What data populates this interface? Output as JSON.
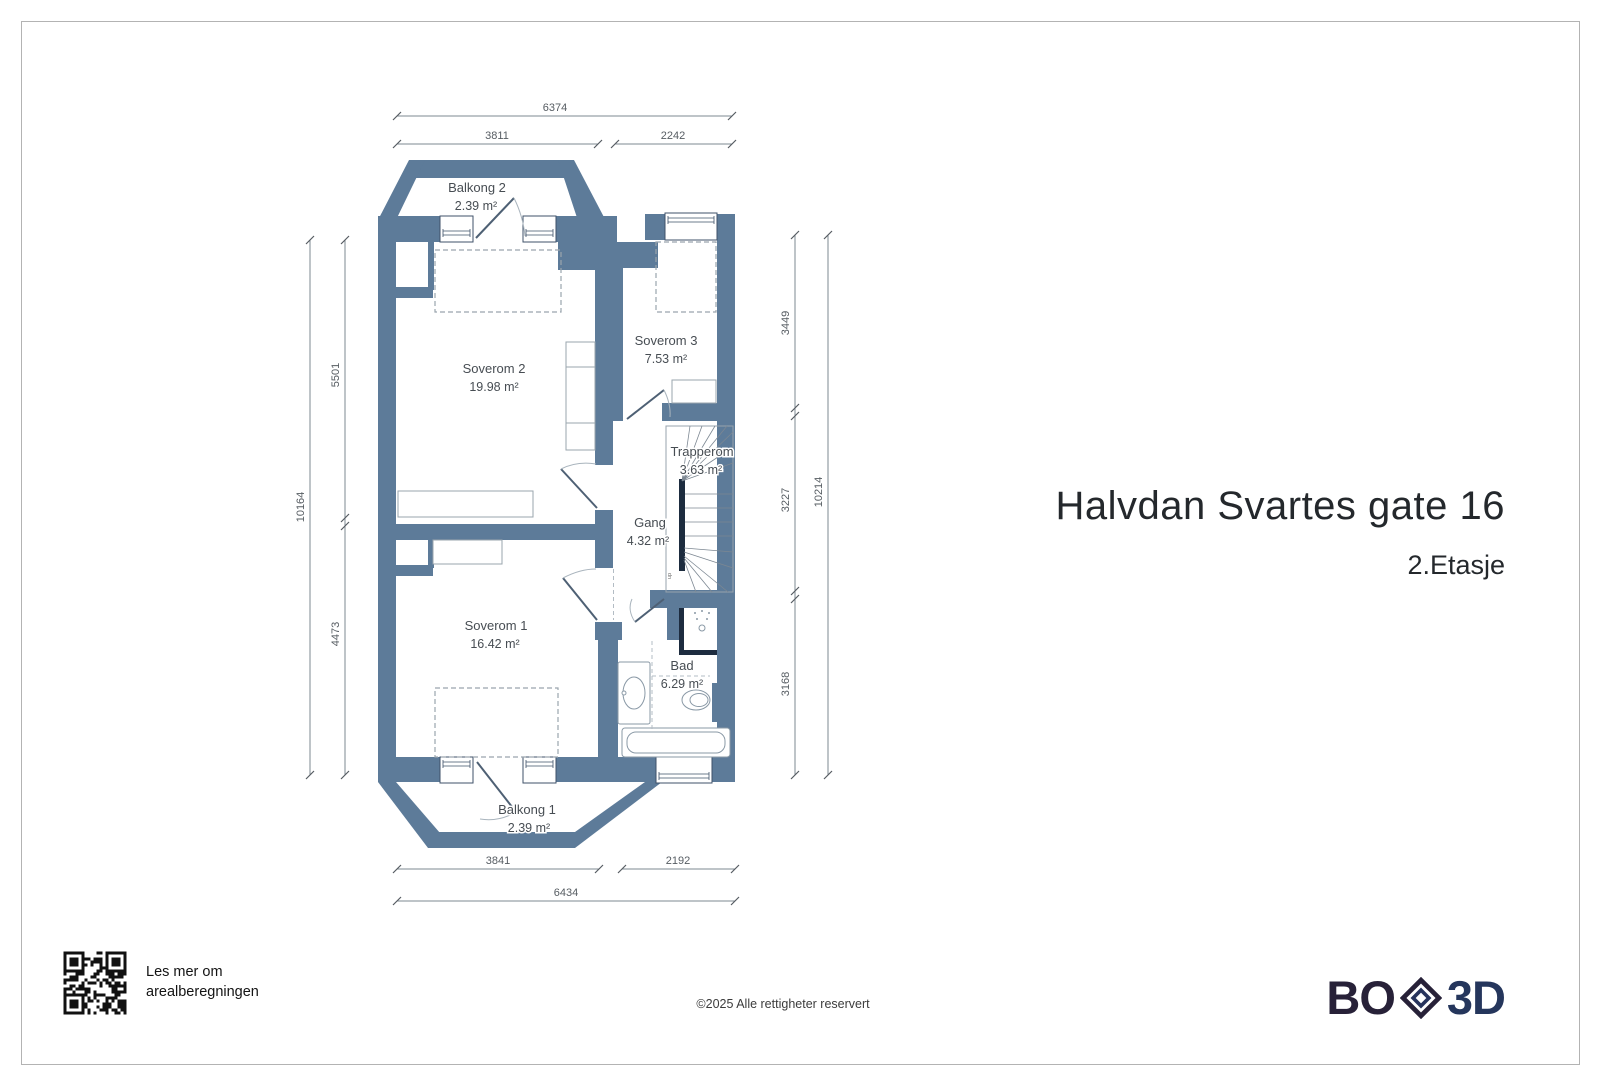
{
  "header": {
    "title": "Halvdan Svartes gate 16",
    "subtitle": "2.Etasje"
  },
  "rooms": {
    "balkong2": {
      "name": "Balkong 2",
      "area": "2.39 m²"
    },
    "soverom2": {
      "name": "Soverom 2",
      "area": "19.98 m²"
    },
    "soverom3": {
      "name": "Soverom 3",
      "area": "7.53 m²"
    },
    "trapperom": {
      "name": "Trapperom",
      "area": "3.63 m²"
    },
    "gang": {
      "name": "Gang",
      "area": "4.32 m²"
    },
    "soverom1": {
      "name": "Soverom 1",
      "area": "16.42 m²"
    },
    "bad": {
      "name": "Bad",
      "area": "6.29 m²"
    },
    "balkong1": {
      "name": "Balkong 1",
      "area": "2.39 m²"
    },
    "stairs_up_label": "up"
  },
  "dimensions": {
    "top_total": "6374",
    "top_left": "3811",
    "top_right": "2242",
    "bottom_left": "3841",
    "bottom_right": "2192",
    "bottom_total": "6434",
    "left_outer_total": "10164",
    "left_upper": "5501",
    "left_lower": "4473",
    "right_upper": "3449",
    "right_middle": "3227",
    "right_lower": "3168",
    "right_outer_total": "10214"
  },
  "footer": {
    "qr_caption_line1": "Les mer om",
    "qr_caption_line2": "arealberegningen",
    "copyright": "©2025 Alle rettigheter reservert",
    "logo_left": "BO",
    "logo_right": "3D"
  },
  "colors": {
    "wall": "#5d7b99",
    "dark_wall": "#1d2c3f",
    "logo_dark_purple": "#272138",
    "logo_navy": "#25365c",
    "page_border": "#b3b3b3"
  }
}
